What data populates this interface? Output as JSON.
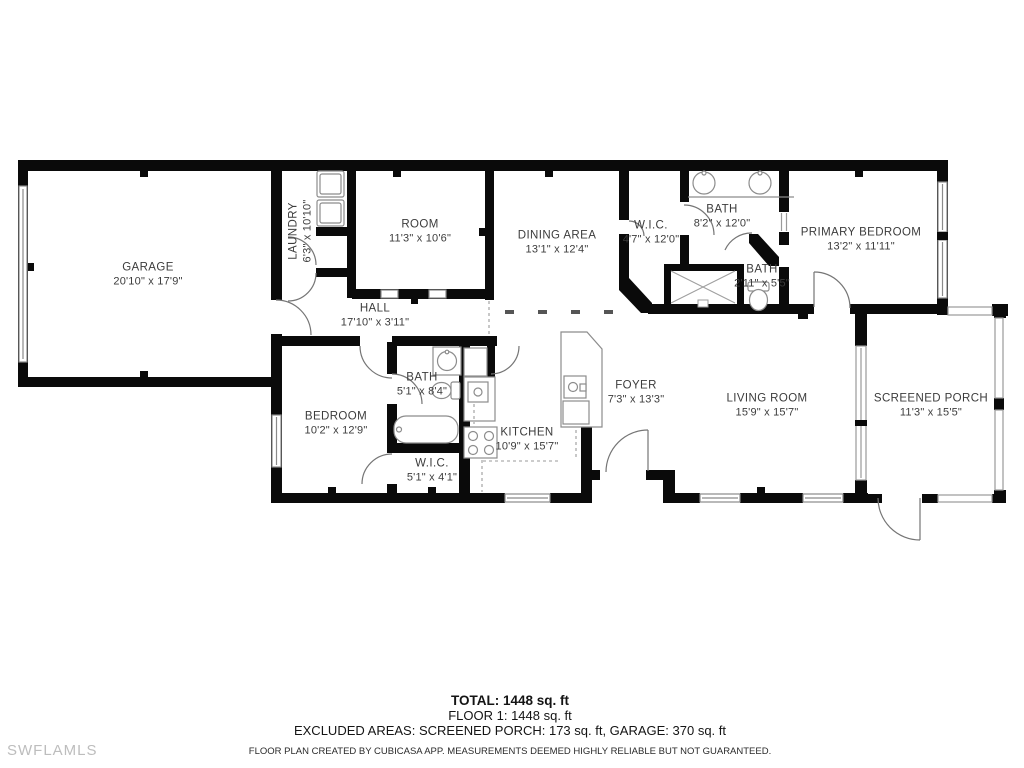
{
  "watermark": "SWFLAMLS",
  "rooms": [
    {
      "name": "GARAGE",
      "dims": "20'10\" x 17'9\""
    },
    {
      "name": "LAUNDRY",
      "dims": "6'3\" x 10'10\""
    },
    {
      "name": "ROOM",
      "dims": "11'3\" x 10'6\""
    },
    {
      "name": "DINING AREA",
      "dims": "13'1\" x 12'4\""
    },
    {
      "name": "W.I.C.",
      "dims": "4'7\" x 12'0\""
    },
    {
      "name": "BATH",
      "dims": "8'2\" x 12'0\""
    },
    {
      "name": "PRIMARY BEDROOM",
      "dims": "13'2\" x 11'11\""
    },
    {
      "name": "BATH",
      "dims": "2'11\" x 5'5\""
    },
    {
      "name": "HALL",
      "dims": "17'10\" x 3'11\""
    },
    {
      "name": "BEDROOM",
      "dims": "10'2\" x 12'9\""
    },
    {
      "name": "BATH",
      "dims": "5'1\" x 8'4\""
    },
    {
      "name": "W.I.C.",
      "dims": "5'1\" x 4'1\""
    },
    {
      "name": "KITCHEN",
      "dims": "10'9\" x 15'7\""
    },
    {
      "name": "FOYER",
      "dims": "7'3\" x 13'3\""
    },
    {
      "name": "LIVING ROOM",
      "dims": "15'9\" x 15'7\""
    },
    {
      "name": "SCREENED PORCH",
      "dims": "11'3\" x 15'5\""
    }
  ],
  "summary": {
    "total": "TOTAL: 1448 sq. ft",
    "floor": "FLOOR 1: 1448 sq. ft",
    "excluded": "EXCLUDED AREAS: SCREENED PORCH: 173 sq. ft, GARAGE: 370 sq. ft",
    "disclaimer": "FLOOR PLAN CREATED BY CUBICASA APP. MEASUREMENTS DEEMED HIGHLY RELIABLE BUT NOT GUARANTEED."
  },
  "colors": {
    "wall": "#0a0a0a",
    "label_text": "#3c3c3c",
    "window_frame": "#8a8a8a",
    "watermark_gray": "#bdbdbd"
  }
}
